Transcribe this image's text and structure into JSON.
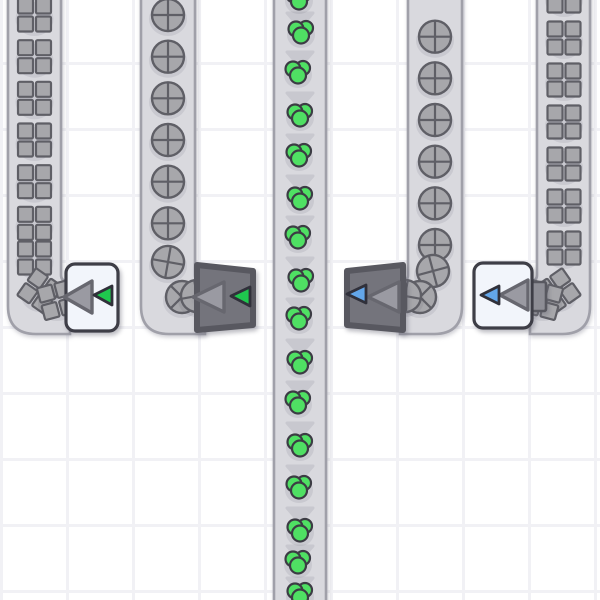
{
  "scene": {
    "width": 600,
    "height": 600,
    "background": {
      "color": "#ffffff",
      "grid_color": "#f1f1f5",
      "grid_size": 66,
      "grid_line_width": 3
    },
    "palette": {
      "belt_fill": "#d9d9de",
      "belt_stroke": "#a0a0a9",
      "chevron": "#c8c8cf",
      "item_gray_fill": "#a7a7ab",
      "item_outline": "#5f5f66",
      "berry_green": "#4fe063",
      "berry_outline": "#3c3c44",
      "white_body": "#f2f5fb",
      "white_border": "#3e3e47",
      "dark_body": "#74747c",
      "dark_border": "#585860",
      "big_triangle_fill": "#9a9aa2",
      "big_triangle_stroke": "#67676f",
      "accent_green": "#1fc84e",
      "accent_blue": "#63a6e9",
      "accent_outline": "#30303a",
      "tail_fill": "#8d8d95",
      "item_shadow": "rgba(70,70,90,0.10)"
    },
    "item_glyphs": {
      "square": "gray-four-square-crate-icon",
      "circle": "gray-crossed-circle-icon",
      "berry": "green-triple-berry-icon"
    },
    "tube": {
      "bottom": 334,
      "corner_radius": 28,
      "width": 53,
      "inner_radius": 6
    },
    "belts": [
      {
        "name": "conveyor-belt-1",
        "item": "square",
        "x1": 8,
        "x2": 61,
        "turn": "right",
        "stub": 70,
        "item_x": 34.5,
        "items_y": [
          15,
          56.7,
          98.3,
          140,
          181.7,
          223.3
        ],
        "curve_items": [
          [
            34.5,
            258,
            0
          ],
          [
            40,
            291,
            35
          ],
          [
            57,
            300,
            75
          ]
        ],
        "chevrons": []
      },
      {
        "name": "conveyor-belt-2",
        "item": "circle",
        "x1": 141,
        "x2": 195,
        "turn": "right",
        "stub": 205,
        "item_x": 168,
        "items_y": [
          15,
          56.7,
          98.3,
          140,
          181.7,
          223.3
        ],
        "curve_items": [
          [
            168,
            262,
            10
          ],
          [
            182,
            297,
            45
          ],
          [
            197,
            296,
            80
          ]
        ],
        "chevrons": []
      },
      {
        "name": "conveyor-belt-center",
        "item": "berry",
        "x1": 274,
        "x2": 326,
        "turn": "none",
        "stub": 0,
        "item_x": 300,
        "items_y": [],
        "curve_items": [
          [
            299,
            -2,
            0
          ],
          [
            301,
            32,
            0
          ],
          [
            298,
            72,
            0
          ],
          [
            300,
            115,
            0
          ],
          [
            299,
            155,
            0
          ],
          [
            300,
            198,
            0
          ],
          [
            298,
            237,
            0
          ],
          [
            301,
            280,
            0
          ],
          [
            299,
            318,
            0
          ],
          [
            300,
            362,
            0
          ],
          [
            298,
            402,
            0
          ],
          [
            300,
            445,
            0
          ],
          [
            299,
            487,
            0
          ],
          [
            300,
            530,
            0
          ],
          [
            298,
            562,
            0
          ],
          [
            300,
            594,
            0
          ]
        ],
        "chevrons": [
          13,
          52,
          93,
          135,
          176,
          217,
          258,
          299,
          340,
          382,
          423,
          466,
          508,
          546,
          578
        ]
      },
      {
        "name": "conveyor-belt-4",
        "item": "circle",
        "x1": 408,
        "x2": 462,
        "turn": "left",
        "stub": 400,
        "item_x": 435,
        "items_y": [
          36.7,
          78.3,
          120,
          161.7,
          203.3,
          245
        ],
        "curve_items": [
          [
            433,
            271,
            -15
          ],
          [
            420,
            297,
            -45
          ],
          [
            405,
            296,
            -80
          ]
        ],
        "chevrons": []
      },
      {
        "name": "conveyor-belt-5",
        "item": "square",
        "x1": 537,
        "x2": 590,
        "turn": "left",
        "stub": 530,
        "item_x": 564,
        "items_y": [
          -4,
          38,
          80,
          122,
          164,
          206,
          248
        ],
        "curve_items": [
          [
            558,
            291,
            -35
          ],
          [
            543,
            300,
            -75
          ]
        ],
        "chevrons": []
      }
    ],
    "machines": [
      {
        "name": "sorter-machine-white-green",
        "kind": "white",
        "accent": "green",
        "body": {
          "x": 66,
          "y": 264,
          "w": 52,
          "h": 67,
          "rx": 9
        },
        "big_triangle": "64,297 92,281 92,313",
        "small_triangle": "94,295 112,286 112,305",
        "tail": null
      },
      {
        "name": "launcher-machine-dark-green",
        "kind": "dark",
        "accent": "green",
        "body_points": "197,265 253,271 253,325 197,330",
        "big_triangle": "193,297 224,282 224,312",
        "small_triangle": "231,296 250,287 250,306",
        "tail": null
      },
      {
        "name": "launcher-machine-dark-blue",
        "kind": "dark",
        "accent": "blue",
        "body_points": "347,271 403,265 403,330 347,325",
        "big_triangle": "368,297 399,282 399,312",
        "small_triangle": "347,294 366,285 366,303",
        "tail": {
          "x": 394,
          "y": 283,
          "w": 12,
          "h": 28
        }
      },
      {
        "name": "sorter-machine-white-blue",
        "kind": "white",
        "accent": "blue",
        "body": {
          "x": 474,
          "y": 263,
          "w": 58,
          "h": 65,
          "rx": 9
        },
        "big_triangle": "500,295 528,280 528,310",
        "small_triangle": "481,295 499,286 499,304",
        "tail": {
          "x": 524,
          "y": 282,
          "w": 22,
          "h": 29
        }
      }
    ]
  }
}
